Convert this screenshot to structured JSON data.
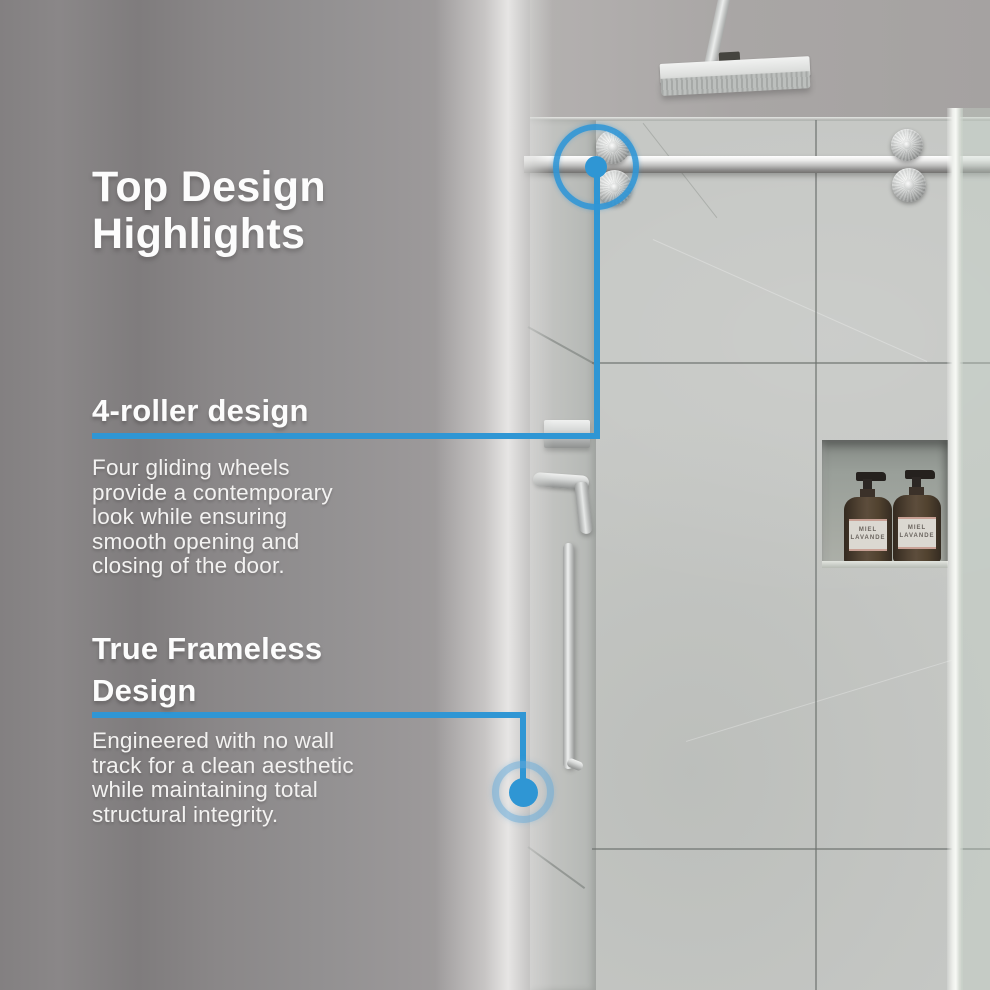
{
  "title": "Top Design\nHighlights",
  "sections": [
    {
      "heading": "4-roller design",
      "body": "Four gliding wheels\nprovide a contemporary\nlook while ensuring\nsmooth opening and\nclosing of the door."
    },
    {
      "heading": "True Frameless\nDesign",
      "body": "Engineered with no wall\ntrack for a clean aesthetic\nwhile maintaining total\nstructural integrity."
    }
  ],
  "scene": {
    "bottle_label": "MIEL\nLAVANDE"
  },
  "colors": {
    "accent_blue": "#2f96d4",
    "background_gray": "#8c898a",
    "tile_gray": "#c5c7c4"
  }
}
